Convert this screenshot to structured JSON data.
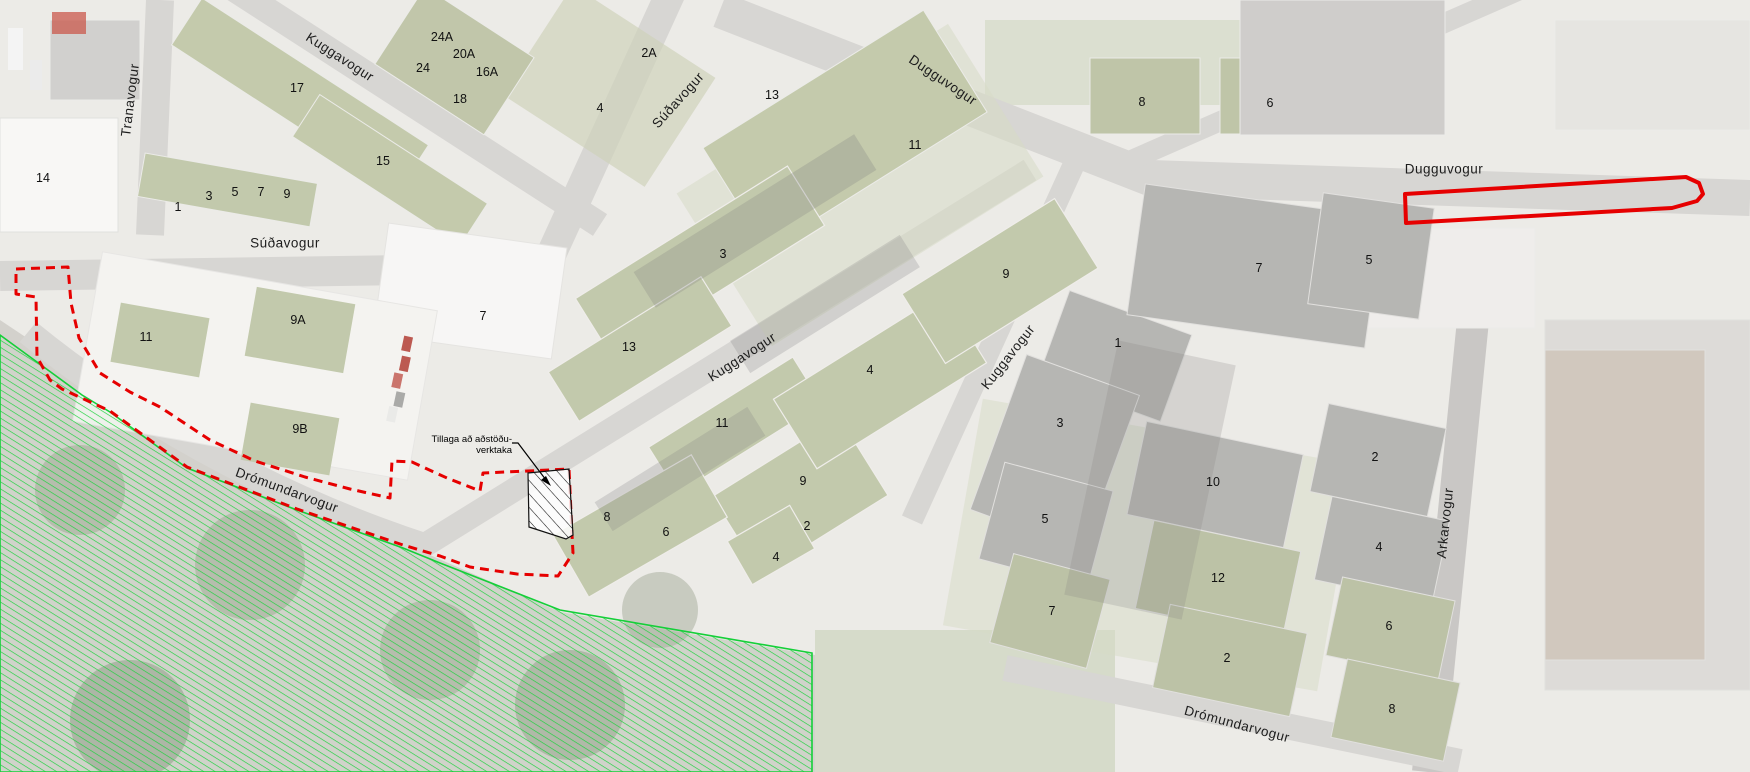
{
  "map": {
    "annotation": {
      "line1": "Tillaga að aðstöðu-",
      "line2": "verktaka"
    },
    "colors": {
      "proposal_boundary_red": "#e60000",
      "proposed_site_outline_red": "#e60000",
      "green_area_hatch": "#1ed23e",
      "contractor_area_hatch": "#111111"
    },
    "streets": [
      {
        "name": "Tranavogur",
        "x": 130,
        "y": 100,
        "rot": -83
      },
      {
        "name": "Kuggavogur",
        "x": 340,
        "y": 57,
        "rot": 33
      },
      {
        "name": "Súðavogur",
        "x": 285,
        "y": 243,
        "rot": 0
      },
      {
        "name": "Súðavogur",
        "x": 678,
        "y": 100,
        "rot": -48
      },
      {
        "name": "Dugguvogur",
        "x": 943,
        "y": 80,
        "rot": 34
      },
      {
        "name": "Dugguvogur",
        "x": 1444,
        "y": 169,
        "rot": 0
      },
      {
        "name": "Kuggavogur",
        "x": 742,
        "y": 357,
        "rot": -33
      },
      {
        "name": "Kuggavogur",
        "x": 1008,
        "y": 357,
        "rot": -52
      },
      {
        "name": "Arkarvogur",
        "x": 1445,
        "y": 523,
        "rot": -84
      },
      {
        "name": "Drómundarvogur",
        "x": 287,
        "y": 490,
        "rot": 20
      },
      {
        "name": "Drómundarvogur",
        "x": 1237,
        "y": 724,
        "rot": 15
      }
    ],
    "buildings": [
      {
        "n": "14",
        "x": 43,
        "y": 178
      },
      {
        "n": "1",
        "x": 178,
        "y": 207
      },
      {
        "n": "3",
        "x": 209,
        "y": 196
      },
      {
        "n": "5",
        "x": 235,
        "y": 192
      },
      {
        "n": "7",
        "x": 261,
        "y": 192
      },
      {
        "n": "9",
        "x": 287,
        "y": 194
      },
      {
        "n": "17",
        "x": 297,
        "y": 88
      },
      {
        "n": "15",
        "x": 383,
        "y": 161
      },
      {
        "n": "24A",
        "x": 442,
        "y": 37
      },
      {
        "n": "24",
        "x": 423,
        "y": 68
      },
      {
        "n": "20A",
        "x": 464,
        "y": 54
      },
      {
        "n": "16A",
        "x": 487,
        "y": 72
      },
      {
        "n": "18",
        "x": 460,
        "y": 99
      },
      {
        "n": "2A",
        "x": 649,
        "y": 53
      },
      {
        "n": "4",
        "x": 600,
        "y": 108
      },
      {
        "n": "13",
        "x": 772,
        "y": 95
      },
      {
        "n": "11",
        "x": 915,
        "y": 145
      },
      {
        "n": "8",
        "x": 1142,
        "y": 102
      },
      {
        "n": "6",
        "x": 1270,
        "y": 103
      },
      {
        "n": "3",
        "x": 723,
        "y": 254
      },
      {
        "n": "13",
        "x": 629,
        "y": 347
      },
      {
        "n": "11",
        "x": 722,
        "y": 423
      },
      {
        "n": "4",
        "x": 870,
        "y": 370
      },
      {
        "n": "9",
        "x": 1006,
        "y": 274
      },
      {
        "n": "9",
        "x": 803,
        "y": 481
      },
      {
        "n": "2",
        "x": 807,
        "y": 526
      },
      {
        "n": "4",
        "x": 776,
        "y": 557
      },
      {
        "n": "8",
        "x": 607,
        "y": 517
      },
      {
        "n": "6",
        "x": 666,
        "y": 532
      },
      {
        "n": "1",
        "x": 1118,
        "y": 343
      },
      {
        "n": "3",
        "x": 1060,
        "y": 423
      },
      {
        "n": "5",
        "x": 1045,
        "y": 519
      },
      {
        "n": "7",
        "x": 1052,
        "y": 611
      },
      {
        "n": "7",
        "x": 1259,
        "y": 268
      },
      {
        "n": "5",
        "x": 1369,
        "y": 260
      },
      {
        "n": "10",
        "x": 1213,
        "y": 482
      },
      {
        "n": "12",
        "x": 1218,
        "y": 578
      },
      {
        "n": "2",
        "x": 1227,
        "y": 658
      },
      {
        "n": "2",
        "x": 1375,
        "y": 457
      },
      {
        "n": "4",
        "x": 1379,
        "y": 547
      },
      {
        "n": "6",
        "x": 1389,
        "y": 626
      },
      {
        "n": "8",
        "x": 1392,
        "y": 709
      },
      {
        "n": "11",
        "x": 146,
        "y": 337
      },
      {
        "n": "9A",
        "x": 298,
        "y": 320
      },
      {
        "n": "9B",
        "x": 300,
        "y": 429
      },
      {
        "n": "7",
        "x": 483,
        "y": 316
      }
    ]
  }
}
